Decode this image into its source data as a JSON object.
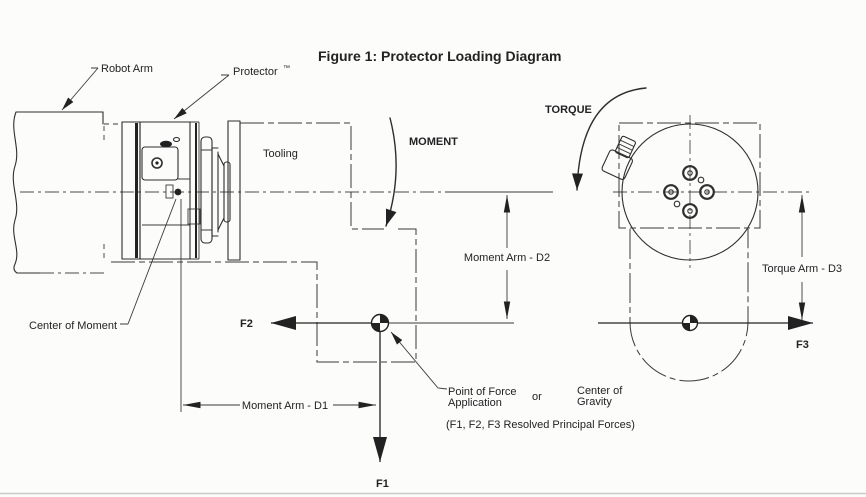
{
  "figure": {
    "title": "Figure 1: Protector Loading Diagram"
  },
  "colors": {
    "line": "#2e2e2e",
    "text": "#222222",
    "background": "#fcfcfb",
    "page_edge": "#c9c9c9"
  },
  "labels": {
    "robot_arm": "Robot Arm",
    "protector": "Protector",
    "protector_tm": "™",
    "tooling": "Tooling",
    "moment": "MOMENT",
    "torque": "TORQUE",
    "center_of_moment": "Center of Moment",
    "point_of_force_line1": "Point of Force",
    "point_of_force_line2": "Application",
    "or": "or",
    "center_of_gravity_line1": "Center of",
    "center_of_gravity_line2": "Gravity",
    "resolved_note": "(F1, F2, F3 Resolved Principal Forces)"
  },
  "forces": {
    "f1": "F1",
    "f2": "F2",
    "f3": "F3"
  },
  "dimensions": {
    "moment_arm_d1": "Moment Arm - D1",
    "moment_arm_d2": "Moment Arm - D2",
    "torque_arm_d3": "Torque Arm - D3"
  }
}
